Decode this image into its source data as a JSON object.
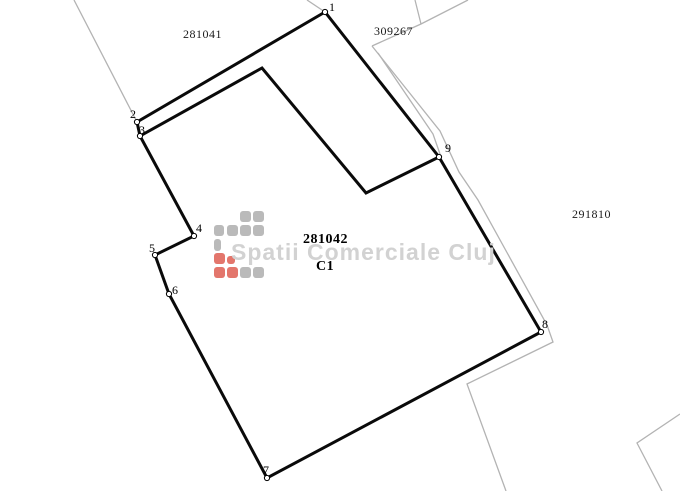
{
  "title": "Cadastral parcel plan",
  "watermark": {
    "text": "Spatii Comerciale Cluj",
    "color": "#d2d2d2"
  },
  "colors": {
    "background": "#ffffff",
    "boundary": "#0a0a0a",
    "neighbor_line": "#b3b3b3",
    "label": "#1a1a1a",
    "vertex_fill": "#ffffff",
    "vertex_stroke": "#000000",
    "logo_gray": "#bababa",
    "logo_red": "#e3766c"
  },
  "parcel_labels": [
    {
      "text": "281041",
      "x": 183,
      "y": 27,
      "bold": false
    },
    {
      "text": "309267",
      "x": 374,
      "y": 24,
      "bold": false
    },
    {
      "text": "291810",
      "x": 572,
      "y": 207,
      "bold": false
    },
    {
      "text": "281042",
      "x": 303,
      "y": 232,
      "bold": true
    },
    {
      "text": "C1",
      "x": 316,
      "y": 259,
      "bold": true
    }
  ],
  "vertices": [
    {
      "n": "1",
      "x": 325,
      "y": 12,
      "lx": 329,
      "ly": 0
    },
    {
      "n": "2",
      "x": 137,
      "y": 122,
      "lx": 130,
      "ly": 107
    },
    {
      "n": "3",
      "x": 140,
      "y": 136,
      "lx": 139,
      "ly": 123
    },
    {
      "n": "4",
      "x": 194,
      "y": 236,
      "lx": 196,
      "ly": 221
    },
    {
      "n": "5",
      "x": 155,
      "y": 255,
      "lx": 149,
      "ly": 241
    },
    {
      "n": "6",
      "x": 169,
      "y": 294,
      "lx": 172,
      "ly": 283
    },
    {
      "n": "7",
      "x": 267,
      "y": 478,
      "lx": 263,
      "ly": 463
    },
    {
      "n": "8",
      "x": 541,
      "y": 332,
      "lx": 542,
      "ly": 317
    },
    {
      "n": "9",
      "x": 439,
      "y": 157,
      "lx": 445,
      "ly": 141
    }
  ],
  "boundary": {
    "closed": true,
    "points": [
      [
        325,
        12
      ],
      [
        137,
        122
      ],
      [
        140,
        136
      ],
      [
        194,
        236
      ],
      [
        155,
        255
      ],
      [
        169,
        294
      ],
      [
        267,
        478
      ],
      [
        541,
        332
      ],
      [
        439,
        157
      ]
    ]
  },
  "building_outline": {
    "closed": false,
    "points": [
      [
        140,
        136
      ],
      [
        262,
        68
      ],
      [
        366,
        193
      ],
      [
        439,
        157
      ]
    ]
  },
  "neighbor_lines": [
    {
      "points": [
        [
          74,
          0
        ],
        [
          137,
          122
        ]
      ]
    },
    {
      "points": [
        [
          307,
          0
        ],
        [
          325,
          12
        ]
      ]
    },
    {
      "points": [
        [
          415,
          0
        ],
        [
          421,
          24
        ]
      ]
    },
    {
      "points": [
        [
          468,
          0
        ],
        [
          421,
          24
        ],
        [
          372,
          46
        ]
      ]
    },
    {
      "points": [
        [
          372,
          46
        ],
        [
          440,
          131
        ],
        [
          459,
          172
        ],
        [
          478,
          200
        ],
        [
          547,
          325
        ],
        [
          553,
          342
        ],
        [
          467,
          384
        ],
        [
          506,
          491
        ]
      ]
    },
    {
      "points": [
        [
          378,
          53
        ],
        [
          433,
          134
        ],
        [
          440,
          154
        ]
      ]
    },
    {
      "points": [
        [
          680,
          414
        ],
        [
          637,
          443
        ],
        [
          662,
          491
        ]
      ]
    }
  ],
  "logo": {
    "squares": [
      {
        "x": 240,
        "y": 211,
        "w": 11,
        "h": 11,
        "c": "g"
      },
      {
        "x": 253,
        "y": 211,
        "w": 11,
        "h": 11,
        "c": "g"
      },
      {
        "x": 214,
        "y": 225,
        "w": 10,
        "h": 11,
        "c": "g"
      },
      {
        "x": 227,
        "y": 225,
        "w": 11,
        "h": 11,
        "c": "g"
      },
      {
        "x": 240,
        "y": 225,
        "w": 11,
        "h": 11,
        "c": "g"
      },
      {
        "x": 253,
        "y": 225,
        "w": 11,
        "h": 11,
        "c": "g"
      },
      {
        "x": 214,
        "y": 239,
        "w": 7,
        "h": 12,
        "c": "g"
      },
      {
        "x": 214,
        "y": 253,
        "w": 11,
        "h": 11,
        "c": "r"
      },
      {
        "x": 227,
        "y": 256,
        "w": 8,
        "h": 8,
        "c": "r"
      },
      {
        "x": 214,
        "y": 267,
        "w": 11,
        "h": 11,
        "c": "r"
      },
      {
        "x": 227,
        "y": 267,
        "w": 11,
        "h": 11,
        "c": "r"
      },
      {
        "x": 240,
        "y": 267,
        "w": 11,
        "h": 11,
        "c": "g"
      },
      {
        "x": 253,
        "y": 267,
        "w": 11,
        "h": 11,
        "c": "g"
      }
    ]
  }
}
